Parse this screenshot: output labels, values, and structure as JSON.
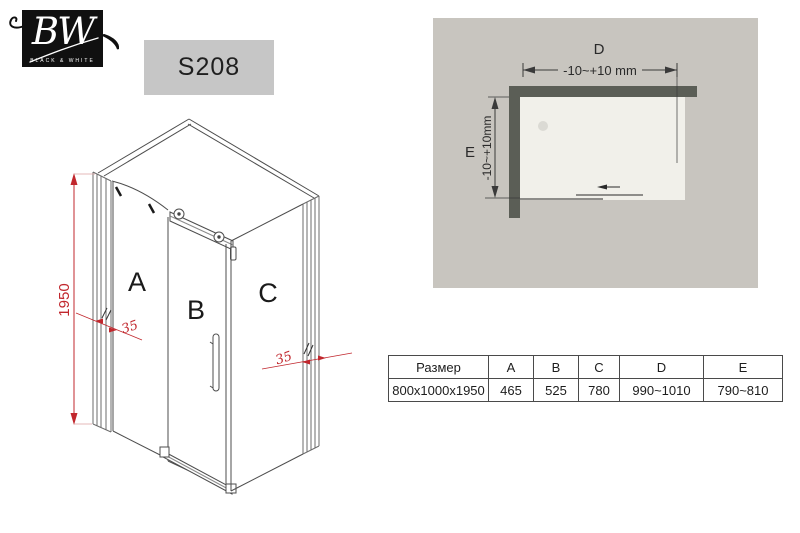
{
  "logo": {
    "monogram": "BW",
    "tagline": "BLACK & WHITE"
  },
  "model": {
    "code": "S208"
  },
  "iso": {
    "panel_a": "A",
    "panel_b": "B",
    "panel_c": "C",
    "height_dim": "1950",
    "wall_offset_left": "35",
    "wall_offset_right": "35"
  },
  "plan": {
    "width_label": "D",
    "width_tolerance": "-10~+10 mm",
    "depth_label": "E",
    "depth_tolerance": "-10~+10mm"
  },
  "table": {
    "headers": [
      "Размер",
      "A",
      "B",
      "C",
      "D",
      "E"
    ],
    "rows": [
      [
        "800x1000x1950",
        "465",
        "525",
        "780",
        "990~1010",
        "790~810"
      ]
    ]
  },
  "colors": {
    "accent_red": "#c1272d",
    "wall": "#5b5e56",
    "tray": "#f1f0ea",
    "panel_bg": "#c8c5bf",
    "badge_bg": "#c6c6c6",
    "line": "#4d4d4d"
  }
}
